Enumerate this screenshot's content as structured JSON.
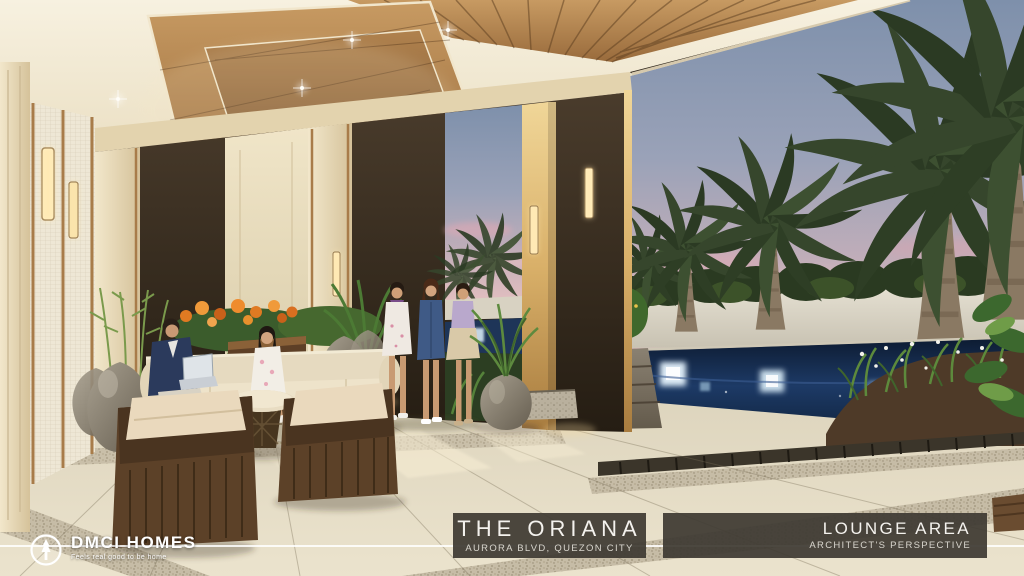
{
  "meta": {
    "kind": "architect-perspective-rendering",
    "scene_caption": "Condominium amenity lounge at dusk opening to a palm garden and lighted reflecting pool"
  },
  "footer": {
    "brand": {
      "name": "DMCI HOMES",
      "tagline": "Feels real good to be home"
    },
    "project": {
      "name": "THE ORIANA",
      "location": "AURORA BLVD, QUEZON CITY"
    },
    "view": {
      "name": "LOUNGE AREA",
      "type": "ARCHITECT'S PERSPECTIVE"
    },
    "banner_bg": "#3e3a33",
    "rule_color": "#ffffff"
  },
  "palette": {
    "sky_top": "#7e90ab",
    "sky_horizon": "#e2bfc0",
    "ceiling_wood": "#b07f4b",
    "dark_wall": "#3a3126",
    "column_cream": "#e9dcb9",
    "accent_gold": "#d9b069",
    "floor_tile": "#e2d9c1",
    "pool_water": "#1d3a66",
    "pool_light_glow": "#e8f6ff",
    "foliage_dark": "#2b3a23",
    "foliage_light": "#6f9c48",
    "stone_planter": "#8a8172"
  }
}
